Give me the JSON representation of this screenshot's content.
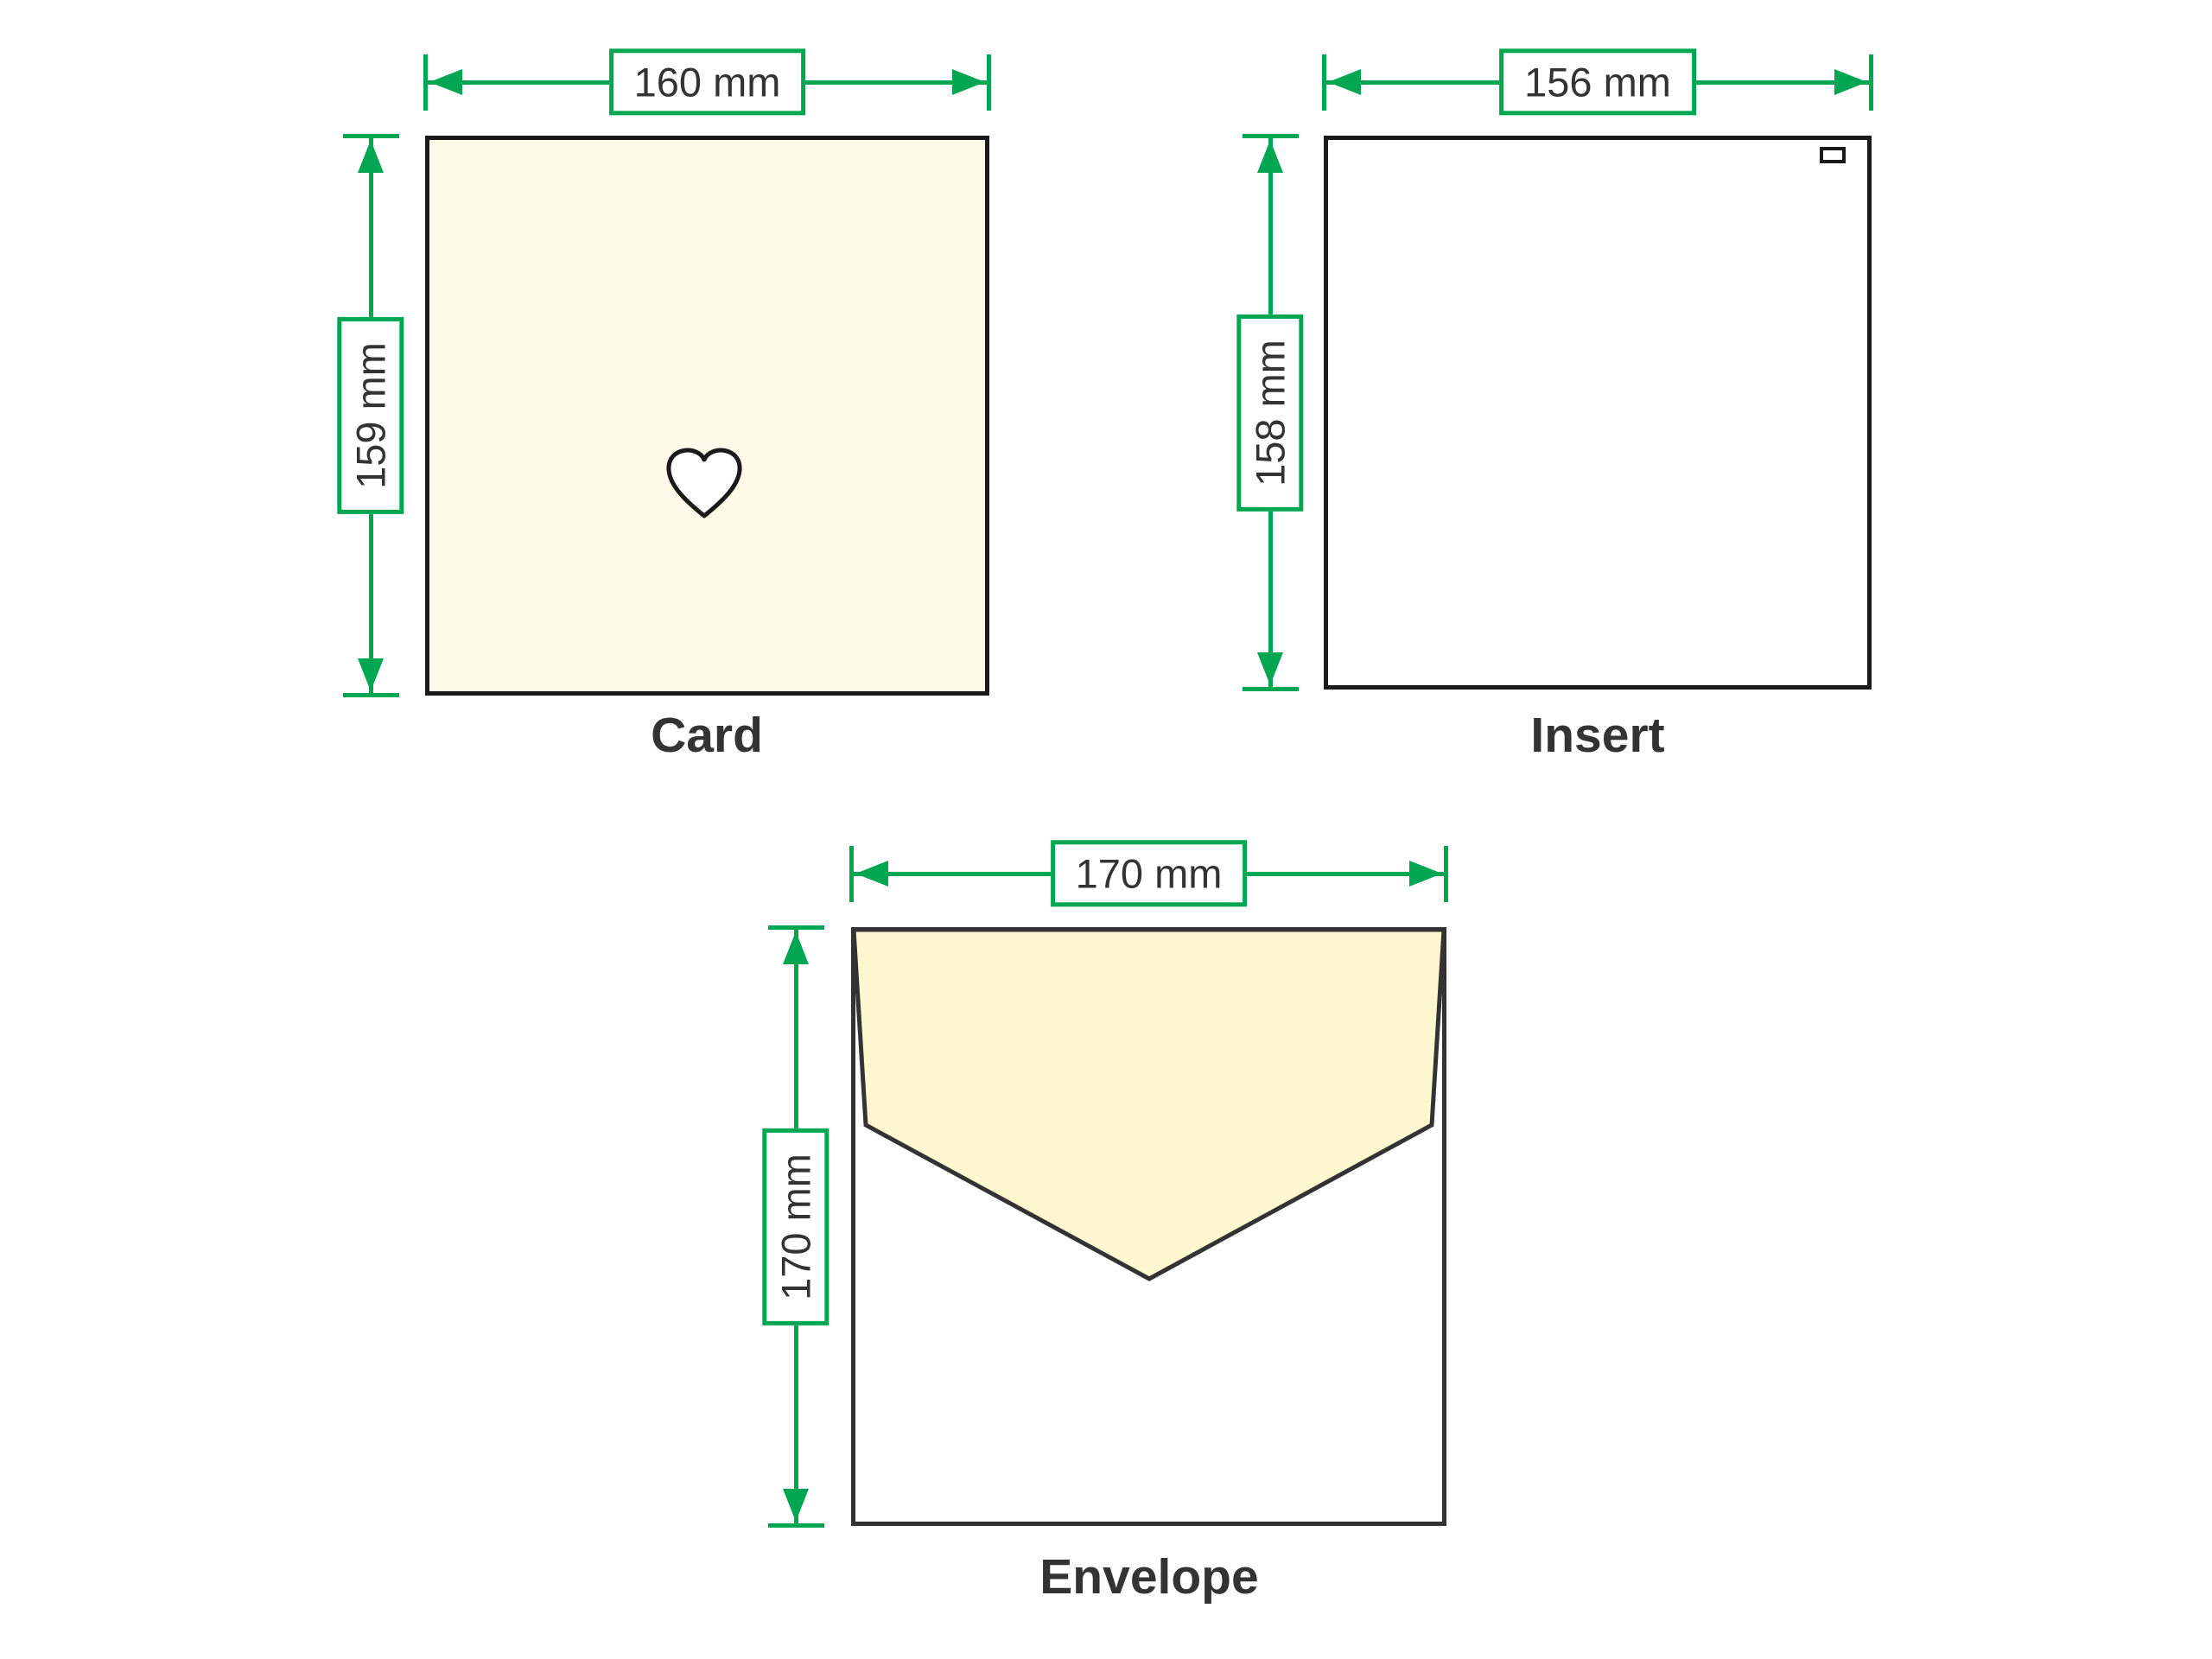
{
  "figures": {
    "card": {
      "caption": "Card",
      "width_label": "160 mm",
      "height_label": "159 mm",
      "fill": "#FDFAE9",
      "center_icon": "heart-outline-icon"
    },
    "insert": {
      "caption": "Insert",
      "width_label": "156 mm",
      "height_label": "158 mm",
      "fill": "#FFFFFF",
      "corner_icon": "tab-rectangle-icon"
    },
    "envelope": {
      "caption": "Envelope",
      "width_label": "170 mm",
      "height_label": "170 mm",
      "flap_fill": "#FDF8D0"
    }
  },
  "colors": {
    "dimension_green": "#00A651",
    "outline_dark": "#1A1A1A",
    "envelope_outline": "#333333",
    "text": "#333333",
    "background": "#FFFFFF"
  }
}
